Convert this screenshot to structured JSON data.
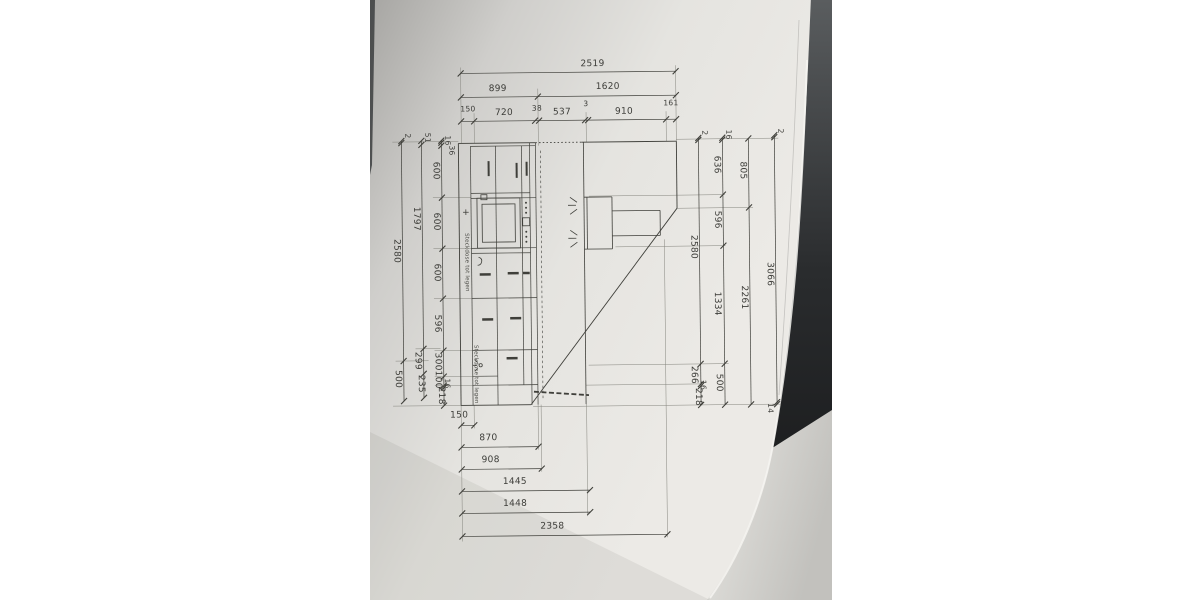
{
  "page": {
    "background": "#ffffff"
  },
  "photo": {
    "paper_color": "#e7e6e2",
    "under_sheet_color": "#d2d1cd",
    "background_color": "#26282a",
    "line_color": "#3f3f3a"
  },
  "drawing": {
    "type": "kitchen-elevation-technical-drawing",
    "dims": {
      "top": [
        [
          "2519"
        ],
        [
          "899",
          "1620"
        ],
        [
          "150",
          "720",
          "38",
          "537",
          "3",
          "910",
          "161"
        ]
      ],
      "left": [
        [
          "2",
          "2580",
          "500"
        ],
        [
          "51",
          "1797",
          "299",
          "235"
        ],
        [
          "16",
          "36",
          "600",
          "600",
          "600",
          "596",
          "300",
          "100",
          "16",
          "218"
        ]
      ],
      "right": [
        [
          "2",
          "2580",
          "266",
          "16",
          "218"
        ],
        [
          "16",
          "636",
          "596",
          "1334",
          "500"
        ],
        [
          "805",
          "2261"
        ],
        [
          "2",
          "3066",
          "14"
        ]
      ],
      "bottom": [
        "150",
        "870",
        "908",
        "1445",
        "1448",
        "2358"
      ]
    },
    "annotations": {
      "socket_note_1": "Steckdose tot legen",
      "socket_note_2": "Steckdose tot legen",
      "plus_symbol": "+"
    }
  }
}
